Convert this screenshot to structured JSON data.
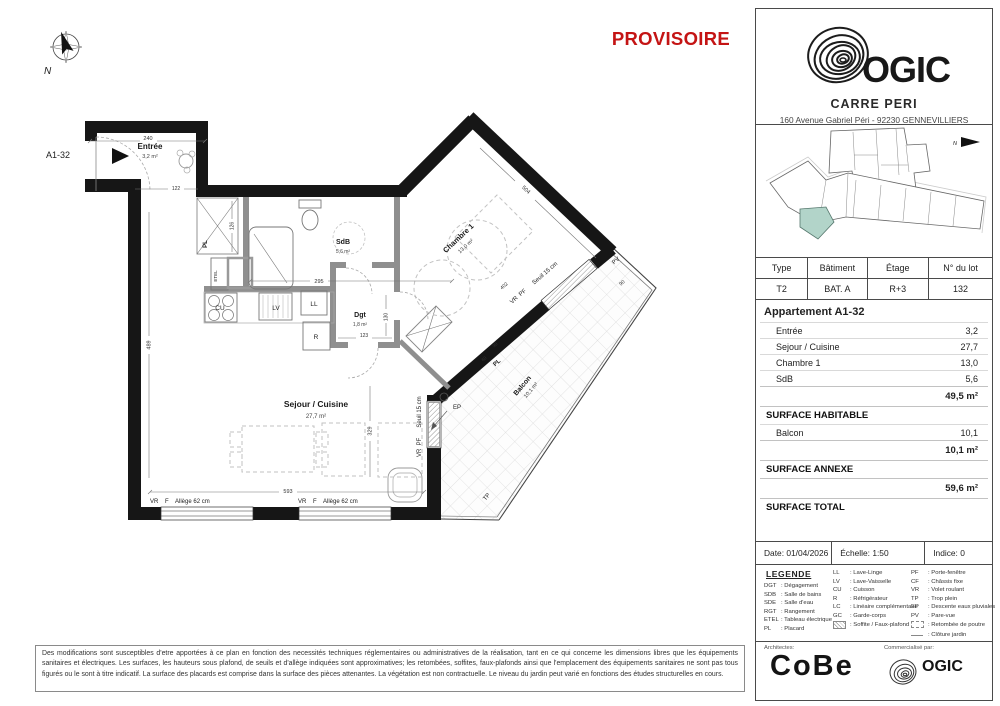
{
  "stamp": {
    "text": "PROVISOIRE",
    "color": "#c41414"
  },
  "plan": {
    "unit_label": "A1-32",
    "north_label": "N",
    "rooms": {
      "entree": {
        "name": "Entrée",
        "area": "3,2 m²"
      },
      "sdb": {
        "name": "SdB",
        "area": "5,6 m²"
      },
      "dgt": {
        "name": "Dgt",
        "area": "1,8 m²"
      },
      "chambre": {
        "name": "Chambre 1",
        "area": "13,0 m²"
      },
      "sejour": {
        "name": "Sejour / Cuisine",
        "area": "27,7 m²"
      },
      "balcon": {
        "name": "Balcon",
        "area": "10,1 m²"
      }
    },
    "ann": {
      "pl": "PL",
      "pl2": "PL",
      "etel": "ETEL",
      "cu": "CU",
      "lv": "LV",
      "ll": "LL",
      "r": "R",
      "ep": "EP",
      "tp": "TP",
      "pv": "PV",
      "vr_pf_seuil": "VR  PF      Seuil 15 cm",
      "vr_f_allege": "VR    F    Allège 62 cm"
    },
    "dims": {
      "d240": "240",
      "d122": "122",
      "d126": "126",
      "d295": "295",
      "d123": "123",
      "d130": "130",
      "d329": "329",
      "d593": "593",
      "d489": "489",
      "d504": "504",
      "d402": "402",
      "d90": "90",
      "d90b": "90",
      "d60": "60"
    }
  },
  "title_block": {
    "brand": "OGIC",
    "project_name": "CARRE PERI",
    "address": "160 Avenue Gabriel Péri - 92230 GENNEVILLIERS",
    "lot_table": {
      "headers": [
        "Type",
        "Bâtiment",
        "Étage",
        "N° du lot"
      ],
      "values": [
        "T2",
        "BAT. A",
        "R+3",
        "132"
      ]
    },
    "areas": {
      "title": "Appartement A1-32",
      "rooms": [
        {
          "label": "Entrée",
          "value": "3,2"
        },
        {
          "label": "Sejour / Cuisine",
          "value": "27,7"
        },
        {
          "label": "Chambre 1",
          "value": "13,0"
        },
        {
          "label": "SdB",
          "value": "5,6"
        }
      ],
      "surface_habitable_value": "49,5 m²",
      "surface_habitable_label": "SURFACE HABITABLE",
      "annexes": [
        {
          "label": "Balcon",
          "value": "10,1"
        }
      ],
      "surface_annexe_value": "10,1 m²",
      "surface_annexe_label": "SURFACE ANNEXE",
      "surface_total_value": "59,6 m²",
      "surface_total_label": "SURFACE TOTAL"
    },
    "meta": {
      "date": "Date: 01/04/2026",
      "scale": "Échelle: 1:50",
      "index": "Indice: 0"
    }
  },
  "legende": {
    "title": "LEGENDE",
    "col1": [
      {
        "abbr": "DGT",
        "label": "Dégagement"
      },
      {
        "abbr": "SDB",
        "label": "Salle de bains"
      },
      {
        "abbr": "SDE",
        "label": "Salle d'eau"
      },
      {
        "abbr": "RGT",
        "label": "Rangement"
      },
      {
        "abbr": "ETEL",
        "label": "Tableau électrique"
      },
      {
        "abbr": "PL",
        "label": "Placard"
      }
    ],
    "col2": [
      {
        "abbr": "LL",
        "label": "Lave-Linge"
      },
      {
        "abbr": "LV",
        "label": "Lave-Vaisselle"
      },
      {
        "abbr": "CU",
        "label": "Cuisson"
      },
      {
        "abbr": "R",
        "label": "Réfrigérateur"
      },
      {
        "abbr": "LC",
        "label": "Linéaire complémentaire"
      },
      {
        "abbr": "GC",
        "label": "Garde-corps"
      },
      {
        "abbr": "",
        "label": "Soffite / Faux-plafond"
      }
    ],
    "col3": [
      {
        "abbr": "PF",
        "label": "Porte-fenêtre"
      },
      {
        "abbr": "CF",
        "label": "Châssis fixe"
      },
      {
        "abbr": "VR",
        "label": "Volet roulant"
      },
      {
        "abbr": "TP",
        "label": "Trop plein"
      },
      {
        "abbr": "EP",
        "label": "Descente eaux pluviales"
      },
      {
        "abbr": "PV",
        "label": "Pare-vue"
      },
      {
        "abbr": "",
        "label": "Retombée de poutre"
      },
      {
        "abbr": "",
        "label": "Clôture jardin"
      }
    ]
  },
  "footer": {
    "architects_label": "Architectes:",
    "architects": "CoBe",
    "commercial_label": "Commercialisé par:",
    "ogic": "OGIC",
    "disclaimer": "Des modifications sont susceptibles d'etre apportées à ce plan en fonction des necessités techniques réglementaires ou administratives de la réalisation, tant en ce qui concerne les dimensions libres que les équipements sanitaires et électriques. Les surfaces, les hauteurs sous plafond, de seuils et d'allège indiquées sont approximatives; les retombées, soffites, faux-plafonds ainsi que l'emplacement des équipements sanitaires ne sont pas tous figurés ou le sont à titre indicatif. La surface des placards est comprise dans la surface des pièces attenantes. La végétation est non contractuelle. Le niveau du jardin peut varié en fonctions des études structurelles en cours."
  }
}
